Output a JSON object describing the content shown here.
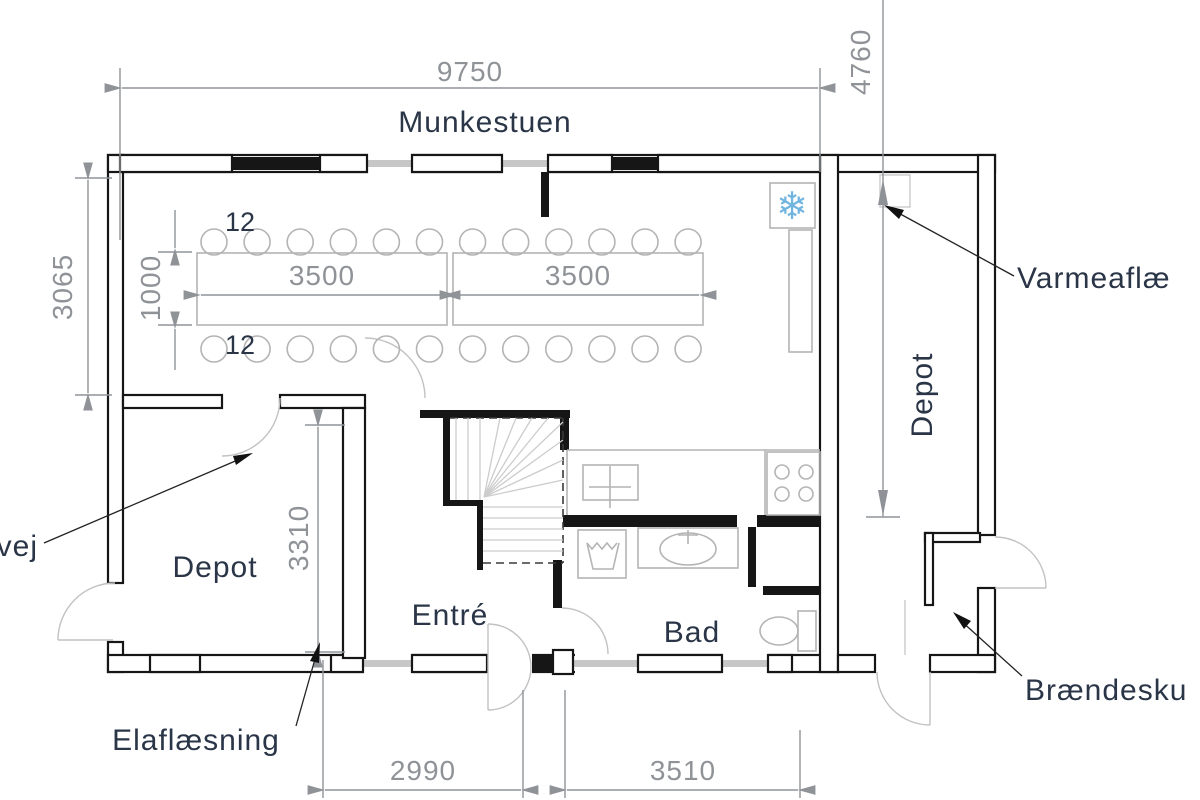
{
  "title": "Floor plan",
  "colors": {
    "wall": "#161616",
    "fixture_gray": "#b4b4b4",
    "glass_gray": "#c7c7c7",
    "dimension_gray": "#8f9398",
    "label_dark": "#2a3547",
    "snowflake_blue": "#70b5e0"
  },
  "rooms": {
    "munkestuen": "Munkestuen",
    "depot_right": "Depot",
    "depot_left": "Depot",
    "entre": "Entré",
    "bad": "Bad"
  },
  "dimensions": {
    "top_width": "9750",
    "right_depth": "4760",
    "left_height": "3065",
    "table_width": "1000",
    "table_length_1": "3500",
    "table_length_2": "3500",
    "chairs_top": "12",
    "chairs_bottom": "12",
    "depot_left_height": "3310",
    "bottom_left": "2990",
    "bottom_right": "3510"
  },
  "annotations": {
    "vej": "vej",
    "elaflaesning": "Elaflæsning",
    "varmeaflaesning": "Varmeaflæ",
    "braendeskur": "Brændesku"
  },
  "icons": {
    "snowflake": "❄"
  },
  "furniture": {
    "chairs_per_row": 12,
    "chair_rows": 2,
    "tables": 2
  }
}
